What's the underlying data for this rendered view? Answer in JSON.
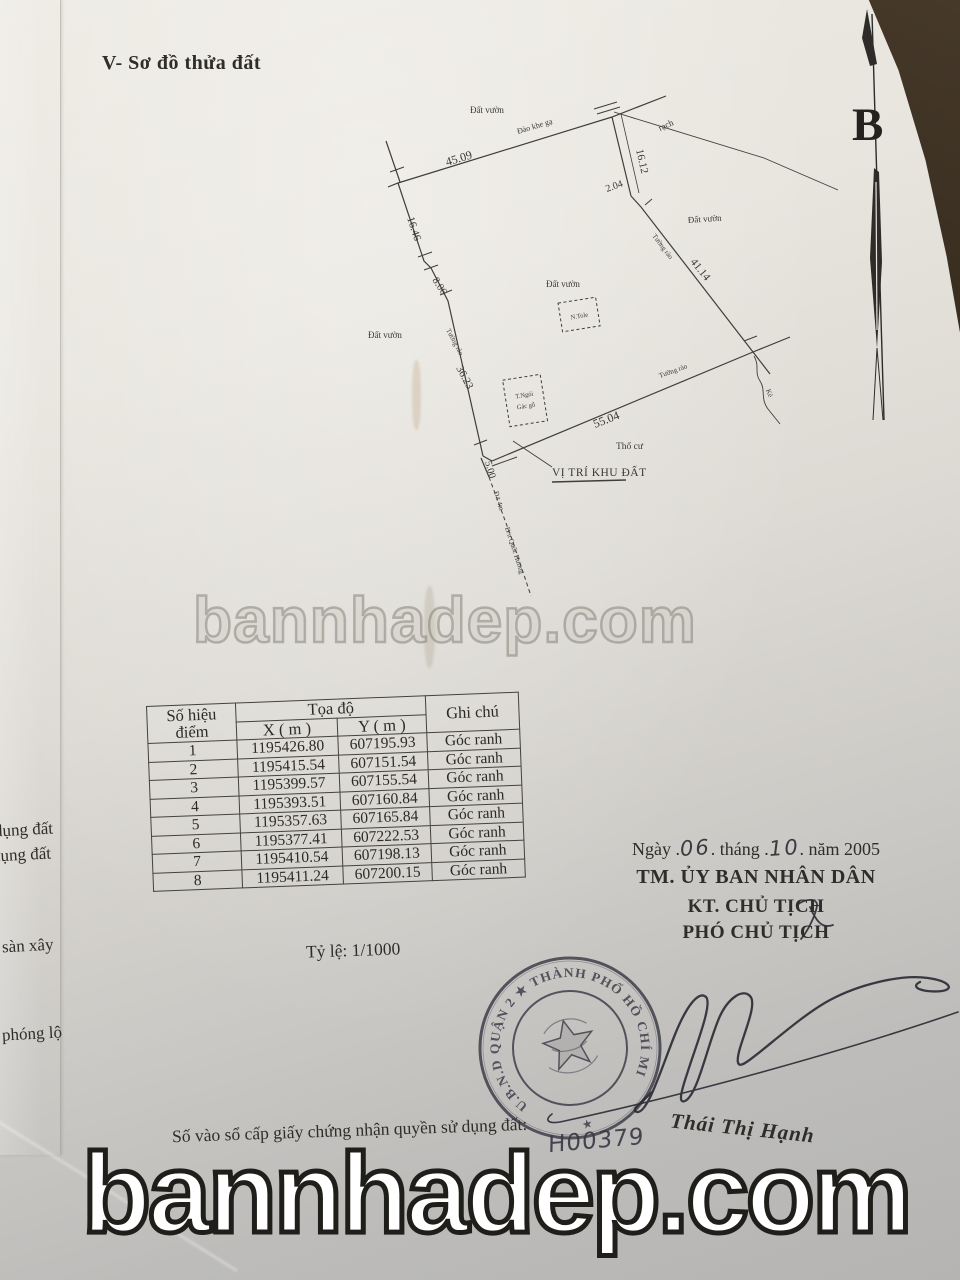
{
  "document": {
    "heading": "V- Sơ đồ thửa đất",
    "compass_label": "B",
    "watermarks": {
      "middle": "bannhadep.com",
      "bottom": "bannhadep.com"
    },
    "diagram": {
      "measure_top": "45.09",
      "measure_right_1": "16.12",
      "measure_right_2": "2.04",
      "measure_right_3": "41.14",
      "measure_left_1": "16.46",
      "measure_left_2": "8.06",
      "measure_left_3": "36.23",
      "measure_bottom": "55.04",
      "measure_sw": "5.00",
      "label_land": "Đất vườn",
      "label_canal": "rạch",
      "label_residential": "Thổ cư",
      "label_fence": "Tường rào",
      "label_site": "VỊ TRÍ KHU ĐẤT",
      "label_top_edge": "Đào khe gạ",
      "label_road_small": "Đ/t 4m",
      "label_road": "Đ/n Quốc Hương",
      "label_embankment": "Kè",
      "house_1": "N.Tole",
      "house_2_line1": "T.Ngói",
      "house_2_line2": "Gác gỗ"
    },
    "table": {
      "col_point_line1": "Số hiệu",
      "col_point_line2": "điểm",
      "col_coord": "Tọa độ",
      "col_x": "X ( m )",
      "col_y": "Y ( m )",
      "col_note": "Ghi chú",
      "rows": [
        {
          "id": "1",
          "x": "1195426.80",
          "y": "607195.93",
          "note": "Góc ranh"
        },
        {
          "id": "2",
          "x": "1195415.54",
          "y": "607151.54",
          "note": "Góc ranh"
        },
        {
          "id": "3",
          "x": "1195399.57",
          "y": "607155.54",
          "note": "Góc ranh"
        },
        {
          "id": "4",
          "x": "1195393.51",
          "y": "607160.84",
          "note": "Góc ranh"
        },
        {
          "id": "5",
          "x": "1195357.63",
          "y": "607165.84",
          "note": "Góc ranh"
        },
        {
          "id": "6",
          "x": "1195377.41",
          "y": "607222.53",
          "note": "Góc ranh"
        },
        {
          "id": "7",
          "x": "1195410.54",
          "y": "607198.13",
          "note": "Góc ranh"
        },
        {
          "id": "8",
          "x": "1195411.24",
          "y": "607200.15",
          "note": "Góc ranh"
        }
      ]
    },
    "scale": "Tỷ lệ: 1/1000",
    "margin_notes": [
      "dụng đất",
      "dụng đất",
      "sàn xây",
      "phóng lộ"
    ],
    "signing": {
      "date_p1": "Ngày .",
      "date_num1": "06",
      "date_p2": ". tháng .",
      "date_num2": "10",
      "date_p3": ". năm 2005",
      "org": "TM. ỦY BAN NHÂN DÂN",
      "kt": "KT. CHỦ TỊCH",
      "deputy": "PHÓ CHỦ TỊCH",
      "stamp_text": "U.B.N.D QUẬN 2 ★ THÀNH PHỐ HỒ CHÍ MINH",
      "stamp_star": "★",
      "register_label": "Số vào sổ cấp giấy chứng nhận quyền sử dụng đất:",
      "register_number": "H00379",
      "signer": "Thái Thị Hạnh"
    }
  }
}
